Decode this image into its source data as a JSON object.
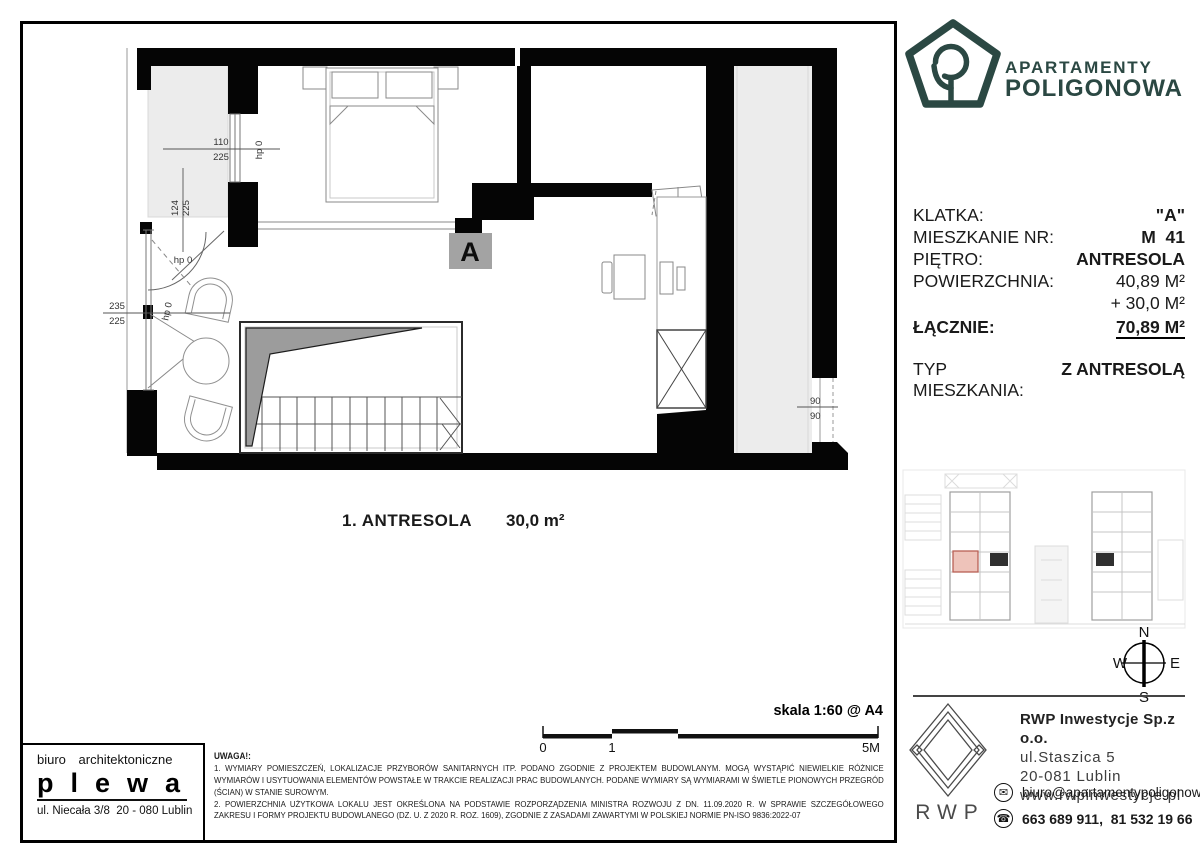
{
  "brand": {
    "line1": "APARTAMENTY",
    "line2": "POLIGONOWA",
    "color": "#2b4843"
  },
  "info": {
    "rows": [
      {
        "label": "KLATKA:",
        "value": "\"A\""
      },
      {
        "label": "MIESZKANIE NR:",
        "value": "M  41"
      },
      {
        "label": "PIĘTRO:",
        "value": "ANTRESOLA"
      },
      {
        "label": "POWIERZCHNIA:",
        "value": "40,89 M²"
      },
      {
        "label": "",
        "value": "+ 30,0 M²"
      },
      {
        "label": "ŁĄCZNIE:",
        "value": "70,89 M²"
      },
      {
        "label": "TYP MIESZKANIA:",
        "value": "Z ANTRESOLĄ"
      }
    ]
  },
  "plan": {
    "room_label": "A",
    "area_name": "1. ANTRESOLA",
    "area_value": "30,0 m²",
    "dims": {
      "win_top_a": "110",
      "win_top_b": "225",
      "left_a": "124",
      "left_b": "225",
      "win_left_a": "235",
      "win_left_b": "225",
      "door_a": "90",
      "door_b": "90",
      "hp": "hp 0"
    }
  },
  "compass": {
    "n": "N",
    "e": "E",
    "s": "S",
    "w": "W"
  },
  "scalebar": {
    "label": "skala 1:60 @ A4",
    "t0": "0",
    "t1": "1",
    "t2": "5M"
  },
  "notes": {
    "title": "UWAGA!:",
    "line1": "1. WYMIARY POMIESZCZEŃ, LOKALIZACJE PRZYBORÓW SANITARNYCH ITP. PODANO ZGODNIE Z PROJEKTEM BUDOWLANYM. MOGĄ WYSTĄPIĆ NIEWIELKIE RÓŻNICE WYMIARÓW I USYTUOWANIA ELEMENTÓW POWSTAŁE W TRAKCIE REALIZACJI PRAC BUDOWLANYCH. PODANE WYMIARY SĄ WYMIARAMI W ŚWIETLE PIONOWYCH PRZEGRÓD (ŚCIAN) W STANIE SUROWYM.",
    "line2": "2. POWIERZCHNIA UŻYTKOWA LOKALU JEST OKREŚLONA NA PODSTAWIE ROZPORZĄDZENIA MINISTRA ROZWOJU Z DN. 11.09.2020 R. W SPRAWIE SZCZEGÓŁOWEGO ZAKRESU I FORMY PROJEKTU BUDOWLANEGO (DZ. U. Z 2020 R. ROZ. 1609), ZGODNIE Z ZASADAMI ZAWARTYMI W POLSKIEJ NORMIE PN-ISO 9836:2022-07"
  },
  "architect": {
    "line1": "biuro architektoniczne",
    "name": "plewa",
    "address": "ul. Niecała 3/8  20 - 080 Lublin"
  },
  "developer": {
    "logo_text": "RWP",
    "company": "RWP Inwestycje Sp.z o.o.",
    "street": "ul.Staszica 5",
    "city": "20-081 Lublin",
    "website": "www.rwpinwestycje.pl",
    "email": "biuro@apartamentypoligonowa.pl",
    "phones": "663 689 911,  81 532 19 66"
  }
}
